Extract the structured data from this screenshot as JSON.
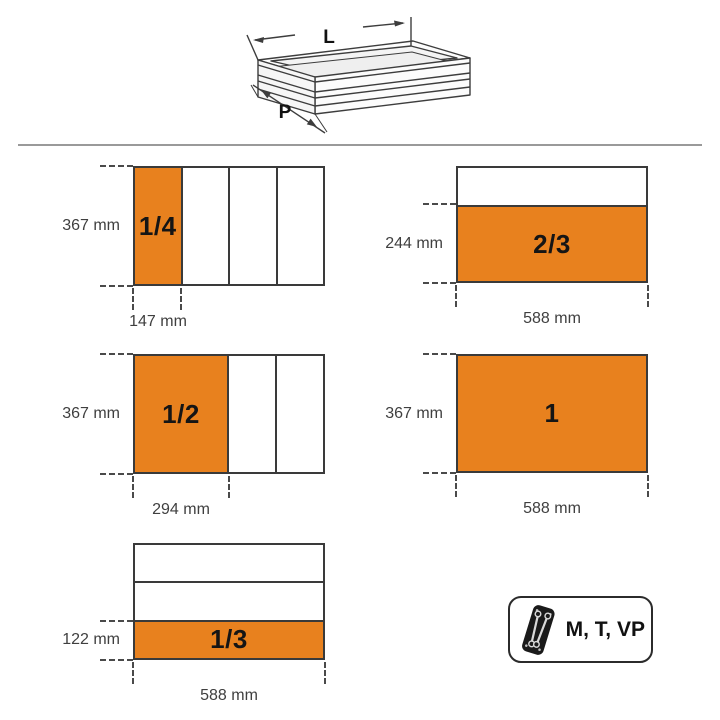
{
  "illustration": {
    "length_label": "L",
    "depth_label": "P"
  },
  "section": {
    "diagrams": [
      {
        "name": "one-quarter",
        "fraction": "1/4",
        "height": "367 mm",
        "width": "147 mm"
      },
      {
        "name": "two-thirds",
        "fraction": "2/3",
        "height": "244 mm",
        "width": "588 mm"
      },
      {
        "name": "one-half",
        "fraction": "1/2",
        "height": "367 mm",
        "width": "294 mm"
      },
      {
        "name": "full",
        "fraction": "1",
        "height": "367 mm",
        "width": "588 mm"
      },
      {
        "name": "one-third",
        "fraction": "1/3",
        "height": "122 mm",
        "width": "588 mm"
      }
    ]
  },
  "badge": {
    "label": "M, T, VP",
    "icon": "wrench-tray-icon"
  },
  "colors": {
    "accent": "#E8811E",
    "line": "#3a3a3a",
    "divider": "#9a9a9a"
  }
}
